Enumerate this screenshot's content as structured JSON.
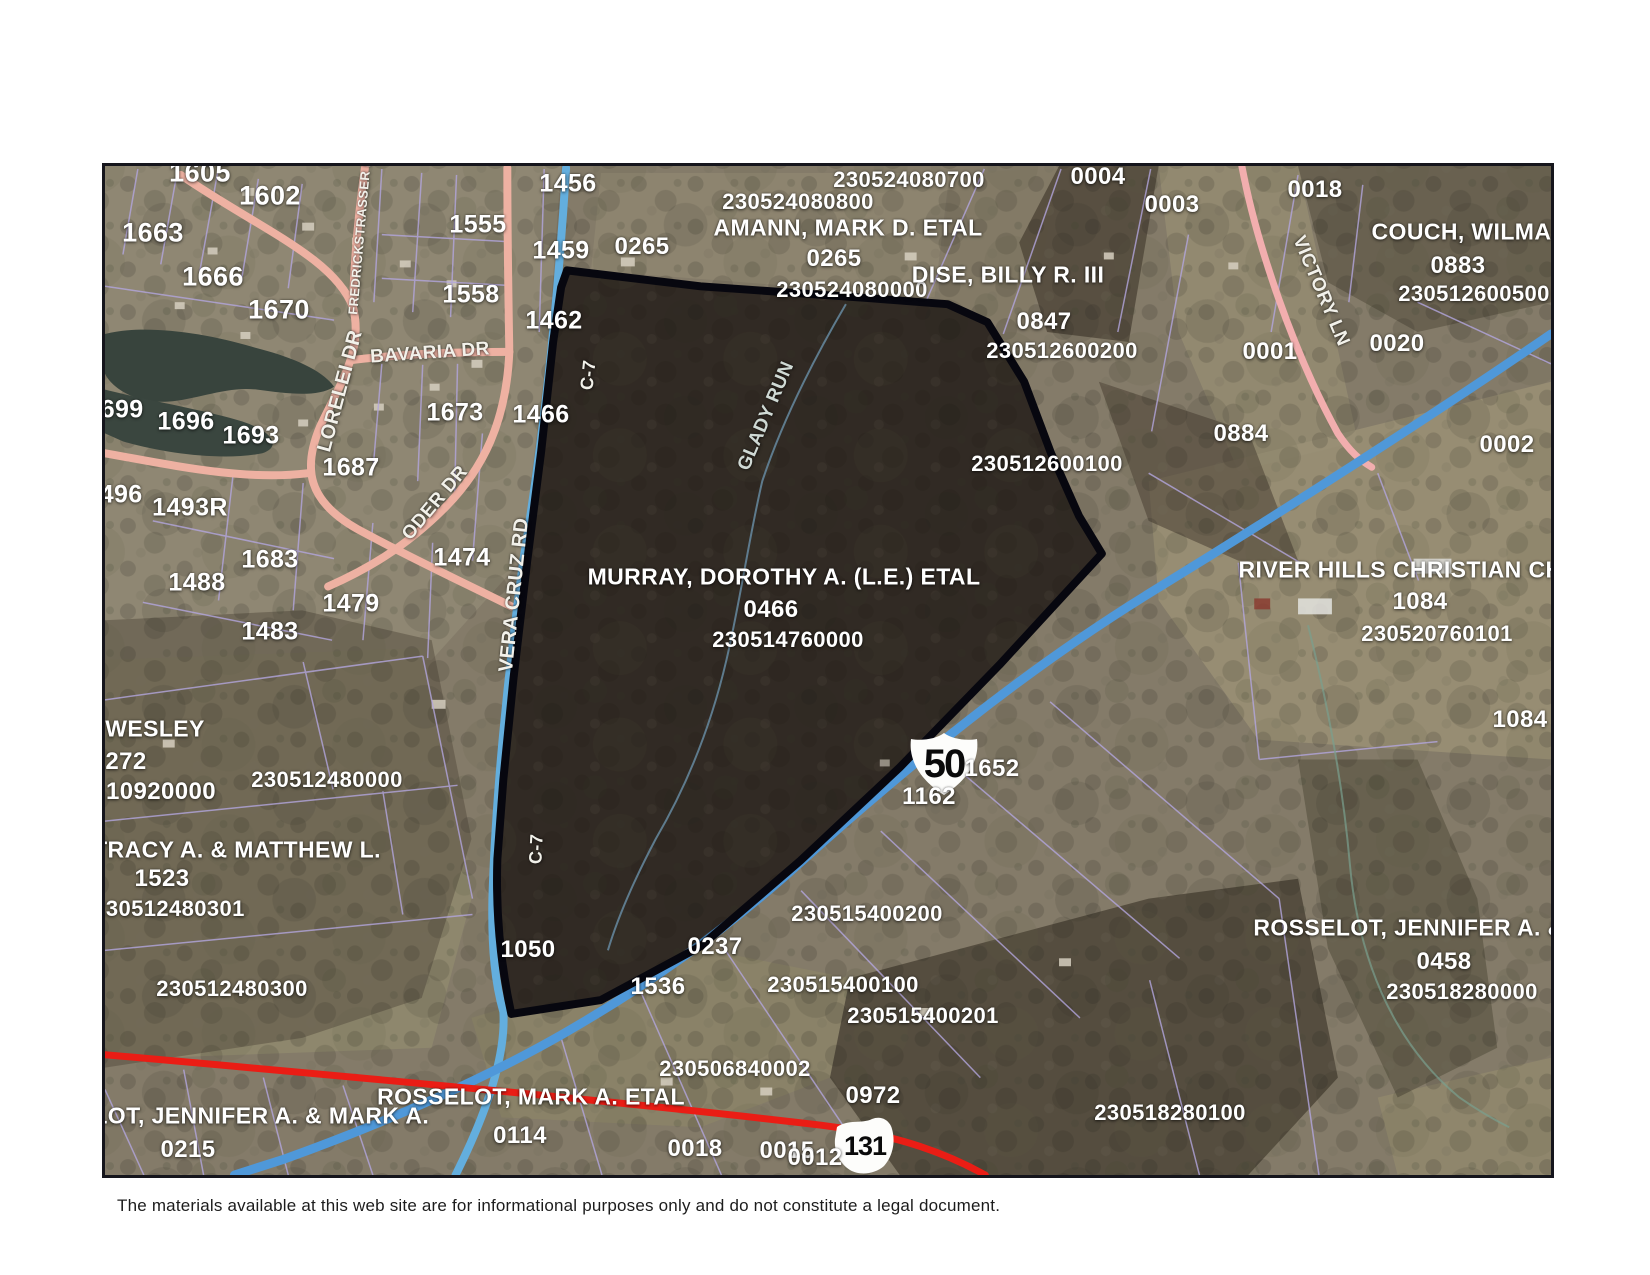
{
  "page": {
    "disclaimer": "The materials available at this web site are for informational purposes only and do not constitute a legal document."
  },
  "map": {
    "colors": {
      "highway_blue": "#4f98d9",
      "township_road_blue": "#63aede",
      "local_road_pink": "#eeb1a2",
      "state_route_red": "#ea1d15",
      "parcel_line_purple": "#b3a6de",
      "selected_parcel_outline": "#07070f",
      "label_white": "#ffffff"
    },
    "route_shields": [
      {
        "route": "US Route 50",
        "number": "50"
      },
      {
        "route": "Ohio Route 131",
        "number": "131"
      }
    ],
    "selected_parcel": {
      "owner": "MURRAY, DOROTHY A. (L.E.) ETAL",
      "parcel_number": "0466",
      "parcel_id": "230514760000"
    },
    "labels": [
      {
        "t": "1605",
        "x": 197,
        "y": 170,
        "s": 27,
        "k": "parcel-number"
      },
      {
        "t": "1602",
        "x": 267,
        "y": 193,
        "s": 27,
        "k": "parcel-number"
      },
      {
        "t": "1663",
        "x": 150,
        "y": 230,
        "s": 27,
        "k": "parcel-number"
      },
      {
        "t": "1666",
        "x": 210,
        "y": 274,
        "s": 27,
        "k": "parcel-number"
      },
      {
        "t": "1670",
        "x": 276,
        "y": 307,
        "s": 27,
        "k": "parcel-number"
      },
      {
        "t": "1456",
        "x": 565,
        "y": 181,
        "s": 25,
        "k": "parcel-number"
      },
      {
        "t": "1555",
        "x": 475,
        "y": 222,
        "s": 25,
        "k": "parcel-number"
      },
      {
        "t": "1459",
        "x": 558,
        "y": 248,
        "s": 25,
        "k": "parcel-number"
      },
      {
        "t": "1558",
        "x": 468,
        "y": 292,
        "s": 25,
        "k": "parcel-number"
      },
      {
        "t": "1462",
        "x": 551,
        "y": 318,
        "s": 25,
        "k": "parcel-number"
      },
      {
        "t": "1673",
        "x": 452,
        "y": 410,
        "s": 25,
        "k": "parcel-number"
      },
      {
        "t": "1466",
        "x": 538,
        "y": 412,
        "s": 25,
        "k": "parcel-number"
      },
      {
        "t": "1699",
        "x": 112,
        "y": 407,
        "s": 25,
        "k": "parcel-number"
      },
      {
        "t": "1696",
        "x": 183,
        "y": 419,
        "s": 25,
        "k": "parcel-number"
      },
      {
        "t": "1693",
        "x": 248,
        "y": 433,
        "s": 25,
        "k": "parcel-number"
      },
      {
        "t": "1687",
        "x": 348,
        "y": 465,
        "s": 25,
        "k": "parcel-number"
      },
      {
        "t": "1496",
        "x": 111,
        "y": 492,
        "s": 25,
        "k": "parcel-number"
      },
      {
        "t": "1493R",
        "x": 187,
        "y": 505,
        "s": 25,
        "k": "parcel-number"
      },
      {
        "t": "1683",
        "x": 267,
        "y": 557,
        "s": 25,
        "k": "parcel-number"
      },
      {
        "t": "1488",
        "x": 194,
        "y": 580,
        "s": 25,
        "k": "parcel-number"
      },
      {
        "t": "1479",
        "x": 348,
        "y": 601,
        "s": 25,
        "k": "parcel-number"
      },
      {
        "t": "1483",
        "x": 267,
        "y": 629,
        "s": 25,
        "k": "parcel-number"
      },
      {
        "t": "1474",
        "x": 459,
        "y": 555,
        "s": 25,
        "k": "parcel-number"
      },
      {
        "t": "0265",
        "x": 639,
        "y": 244,
        "s": 24,
        "k": "parcel-number"
      },
      {
        "t": "0265",
        "x": 831,
        "y": 256,
        "s": 24,
        "k": "parcel-number"
      },
      {
        "t": "0004",
        "x": 1095,
        "y": 174,
        "s": 24,
        "k": "parcel-number"
      },
      {
        "t": "0003",
        "x": 1169,
        "y": 202,
        "s": 24,
        "k": "parcel-number"
      },
      {
        "t": "0018",
        "x": 1312,
        "y": 187,
        "s": 24,
        "k": "parcel-number"
      },
      {
        "t": "0883",
        "x": 1455,
        "y": 263,
        "s": 24,
        "k": "parcel-number"
      },
      {
        "t": "0020",
        "x": 1394,
        "y": 341,
        "s": 24,
        "k": "parcel-number"
      },
      {
        "t": "0001",
        "x": 1267,
        "y": 349,
        "s": 24,
        "k": "parcel-number"
      },
      {
        "t": "0884",
        "x": 1238,
        "y": 431,
        "s": 24,
        "k": "parcel-number"
      },
      {
        "t": "0002",
        "x": 1504,
        "y": 442,
        "s": 24,
        "k": "parcel-number"
      },
      {
        "t": "0847",
        "x": 1041,
        "y": 319,
        "s": 24,
        "k": "parcel-number"
      },
      {
        "t": "0466",
        "x": 768,
        "y": 607,
        "s": 24,
        "k": "parcel-number"
      },
      {
        "t": "1050",
        "x": 525,
        "y": 947,
        "s": 24,
        "k": "parcel-number"
      },
      {
        "t": "1652",
        "x": 989,
        "y": 766,
        "s": 24,
        "k": "parcel-number"
      },
      {
        "t": "1162",
        "x": 926,
        "y": 794,
        "s": 24,
        "k": "parcel-number"
      },
      {
        "t": "0237",
        "x": 712,
        "y": 944,
        "s": 24,
        "k": "parcel-number"
      },
      {
        "t": "1536",
        "x": 655,
        "y": 984,
        "s": 24,
        "k": "parcel-number"
      },
      {
        "t": "1523",
        "x": 159,
        "y": 876,
        "s": 24,
        "k": "parcel-number"
      },
      {
        "t": "0972",
        "x": 870,
        "y": 1093,
        "s": 24,
        "k": "parcel-number"
      },
      {
        "t": "0114",
        "x": 517,
        "y": 1133,
        "s": 24,
        "k": "parcel-number"
      },
      {
        "t": "0018",
        "x": 692,
        "y": 1146,
        "s": 24,
        "k": "parcel-number"
      },
      {
        "t": "0015",
        "x": 784,
        "y": 1148,
        "s": 24,
        "k": "parcel-number"
      },
      {
        "t": "0012",
        "x": 812,
        "y": 1155,
        "s": 24,
        "k": "parcel-number"
      },
      {
        "t": "0215",
        "x": 185,
        "y": 1147,
        "s": 24,
        "k": "parcel-number"
      },
      {
        "t": "0458",
        "x": 1441,
        "y": 959,
        "s": 24,
        "k": "parcel-number"
      },
      {
        "t": "1084",
        "x": 1417,
        "y": 599,
        "s": 24,
        "k": "parcel-number"
      },
      {
        "t": "1084",
        "x": 1517,
        "y": 717,
        "s": 24,
        "k": "parcel-number"
      },
      {
        "t": "272",
        "x": 123,
        "y": 759,
        "s": 24,
        "k": "parcel-number"
      },
      {
        "t": "10920000",
        "x": 158,
        "y": 789,
        "s": 24,
        "k": "parcel-number"
      },
      {
        "t": "230524080700",
        "x": 906,
        "y": 177,
        "s": 22,
        "k": "parcel-id"
      },
      {
        "t": "230524080800",
        "x": 795,
        "y": 199,
        "s": 22,
        "k": "parcel-id"
      },
      {
        "t": "230524080000",
        "x": 849,
        "y": 287,
        "s": 22,
        "k": "parcel-id"
      },
      {
        "t": "230512600200",
        "x": 1059,
        "y": 348,
        "s": 22,
        "k": "parcel-id"
      },
      {
        "t": "230512600500",
        "x": 1471,
        "y": 291,
        "s": 22,
        "k": "parcel-id"
      },
      {
        "t": "230512600100",
        "x": 1044,
        "y": 461,
        "s": 22,
        "k": "parcel-id"
      },
      {
        "t": "230514760000",
        "x": 785,
        "y": 637,
        "s": 22,
        "k": "parcel-id"
      },
      {
        "t": "230512480000",
        "x": 324,
        "y": 777,
        "s": 22,
        "k": "parcel-id"
      },
      {
        "t": "230512480301",
        "x": 166,
        "y": 906,
        "s": 22,
        "k": "parcel-id"
      },
      {
        "t": "230512480300",
        "x": 229,
        "y": 986,
        "s": 22,
        "k": "parcel-id"
      },
      {
        "t": "230515400200",
        "x": 864,
        "y": 911,
        "s": 22,
        "k": "parcel-id"
      },
      {
        "t": "230515400100",
        "x": 840,
        "y": 982,
        "s": 22,
        "k": "parcel-id"
      },
      {
        "t": "230515400201",
        "x": 920,
        "y": 1013,
        "s": 22,
        "k": "parcel-id"
      },
      {
        "t": "230506840002",
        "x": 732,
        "y": 1066,
        "s": 22,
        "k": "parcel-id"
      },
      {
        "t": "230518280000",
        "x": 1459,
        "y": 989,
        "s": 22,
        "k": "parcel-id"
      },
      {
        "t": "230518280100",
        "x": 1167,
        "y": 1110,
        "s": 22,
        "k": "parcel-id"
      },
      {
        "t": "230520760101",
        "x": 1434,
        "y": 631,
        "s": 22,
        "k": "parcel-id"
      },
      {
        "t": "AMANN, MARK D. ETAL",
        "x": 845,
        "y": 225,
        "s": 23,
        "k": "owner-name"
      },
      {
        "t": "DISE, BILLY R. III",
        "x": 1005,
        "y": 272,
        "s": 23,
        "k": "owner-name"
      },
      {
        "t": "COUCH, WILMA J",
        "x": 1468,
        "y": 229,
        "s": 23,
        "k": "owner-name"
      },
      {
        "t": "MURRAY, DOROTHY A. (L.E.) ETAL",
        "x": 781,
        "y": 574,
        "s": 23,
        "k": "owner-name"
      },
      {
        "t": "RIVER HILLS CHRISTIAN CHU",
        "x": 1406,
        "y": 567,
        "s": 23,
        "k": "owner-name"
      },
      {
        "t": "ROSSELOT, JENNIFER A. &",
        "x": 1406,
        "y": 925,
        "s": 23,
        "k": "owner-name"
      },
      {
        "t": "ROSSELOT, MARK A. ETAL",
        "x": 528,
        "y": 1094,
        "s": 23,
        "k": "owner-name"
      },
      {
        "t": "ROSSELOT, JENNIFER A. & MARK A.",
        "x": 217,
        "y": 1113,
        "s": 23,
        "k": "owner-name"
      },
      {
        "t": "WESLEY",
        "x": 152,
        "y": 726,
        "s": 23,
        "k": "owner-name"
      },
      {
        "t": "TRACY A. & MATTHEW L.",
        "x": 234,
        "y": 847,
        "s": 23,
        "k": "owner-name"
      },
      {
        "t": "LORELEI DR",
        "x": 337,
        "y": 388,
        "s": 20,
        "r": -75,
        "k": "road-name"
      },
      {
        "t": "BAVARIA DR",
        "x": 427,
        "y": 350,
        "s": 19,
        "r": -4,
        "k": "road-name"
      },
      {
        "t": "ODER DR",
        "x": 432,
        "y": 500,
        "s": 19,
        "r": -50,
        "k": "road-name"
      },
      {
        "t": "VERA CRUZ RD",
        "x": 511,
        "y": 592,
        "s": 20,
        "r": -84,
        "k": "road-name"
      },
      {
        "t": "VICTORY LN",
        "x": 1318,
        "y": 288,
        "s": 19,
        "r": 67,
        "k": "road-name"
      },
      {
        "t": "FREDRICKSTRASSER DR",
        "x": 357,
        "y": 228,
        "s": 13,
        "r": -85,
        "k": "road-name"
      },
      {
        "t": "C-7",
        "x": 585,
        "y": 372,
        "s": 18,
        "r": -84,
        "k": "route-designation"
      },
      {
        "t": "C-7",
        "x": 533,
        "y": 846,
        "s": 18,
        "r": -87,
        "k": "route-designation"
      },
      {
        "t": "GLADY RUN",
        "x": 763,
        "y": 413,
        "s": 19,
        "r": -67,
        "k": "stream-name",
        "c": "#cfd9d4"
      }
    ]
  }
}
